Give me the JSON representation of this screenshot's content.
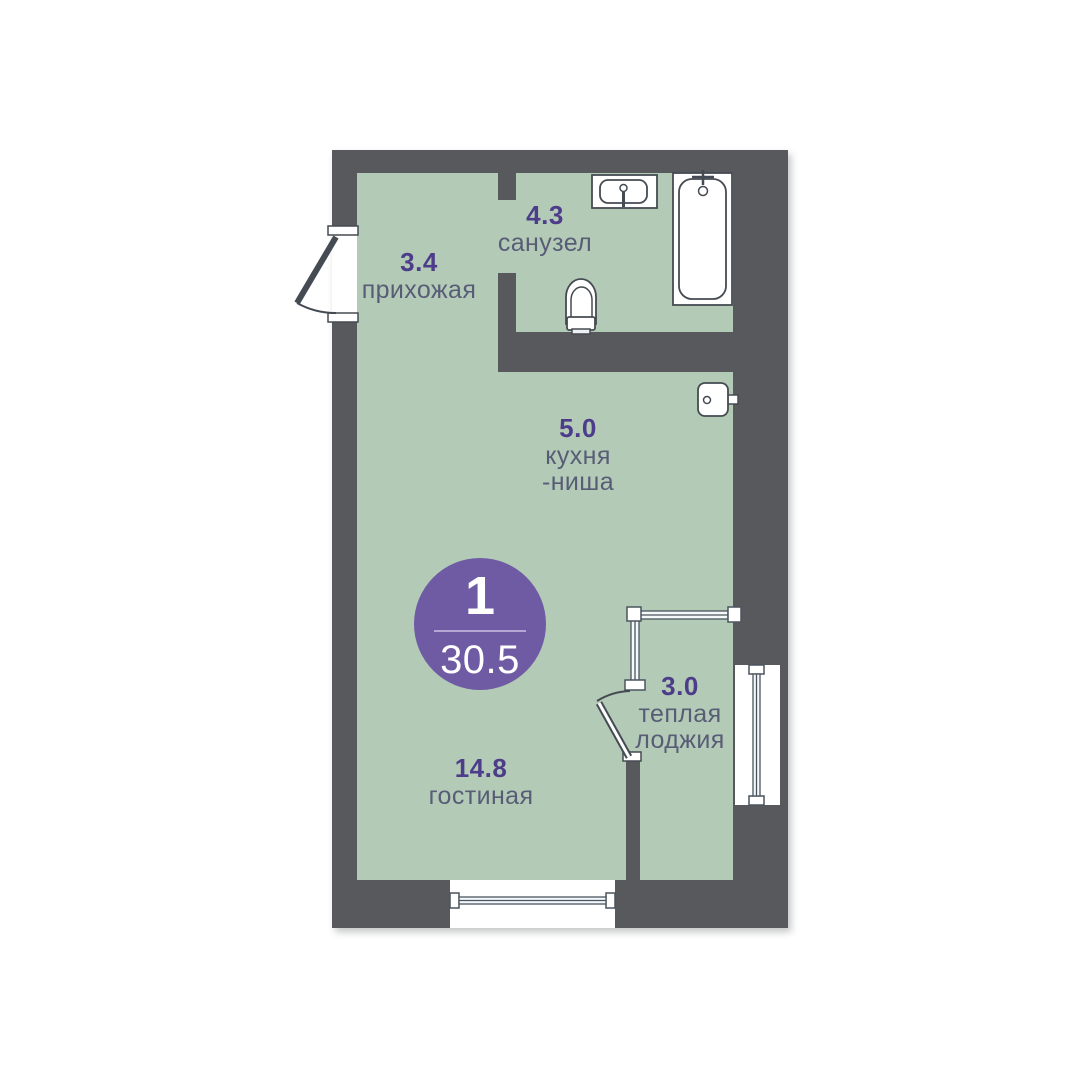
{
  "plan": {
    "badge": {
      "rooms_count": "1",
      "total_area": "30.5"
    },
    "rooms": [
      {
        "area": "3.4",
        "name": "прихожая"
      },
      {
        "area": "4.3",
        "name": "санузел"
      },
      {
        "area": "5.0",
        "name": "кухня",
        "name2": "-ниша"
      },
      {
        "area": "14.8",
        "name": "гостиная"
      },
      {
        "area": "3.0",
        "name": "теплая",
        "name2": "лоджия"
      }
    ],
    "fixtures": [
      "entrance-door",
      "sink",
      "bathtub",
      "toilet",
      "kitchen-sink",
      "loggia-glazing",
      "loggia-door",
      "window-bottom",
      "window-right"
    ],
    "colors": {
      "wall": "#58595d",
      "room_fill": "#b3cbb6",
      "area_number": "#4d3c8a",
      "room_name": "#585c76",
      "badge_fill": "#6f5ba4",
      "fixture_stroke": "#454b52"
    }
  }
}
